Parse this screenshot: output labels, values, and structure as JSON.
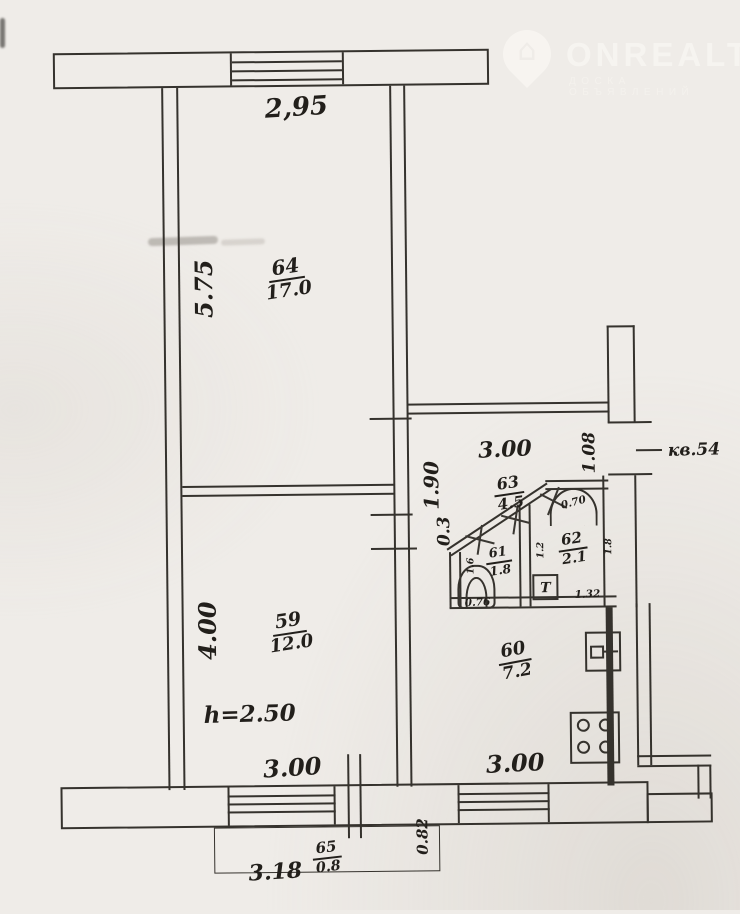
{
  "watermark": {
    "brand": "ONREALT",
    "subtitle": "ДОСКА ОБЪЯВЛЕНИЙ"
  },
  "labels": {
    "top_width": "2,95",
    "apt": "кв.54",
    "living": {
      "no": "64",
      "area": "17.0",
      "h": "5.75"
    },
    "bedroom": {
      "no": "59",
      "area": "12.0",
      "h": "4.00",
      "w": "3.00",
      "note": "h=2.50"
    },
    "hall": {
      "no": "63",
      "area": "4.5",
      "w": "3.00",
      "d": "1.90",
      "s": "0.3",
      "side": "1.08"
    },
    "bath": {
      "no": "61",
      "area": "1.8",
      "w": "0.76",
      "d": "1.6"
    },
    "wc": {
      "no": "62",
      "area": "2.1",
      "l": "1.2",
      "r": "1.8",
      "door": "0.70",
      "tank": "T",
      "b": "1.32"
    },
    "kitchen": {
      "no": "60",
      "area": "7.2",
      "w": "3.00"
    },
    "balcony": {
      "no": "65",
      "area": "0.8",
      "w": "3.18",
      "d": "0.82"
    }
  }
}
